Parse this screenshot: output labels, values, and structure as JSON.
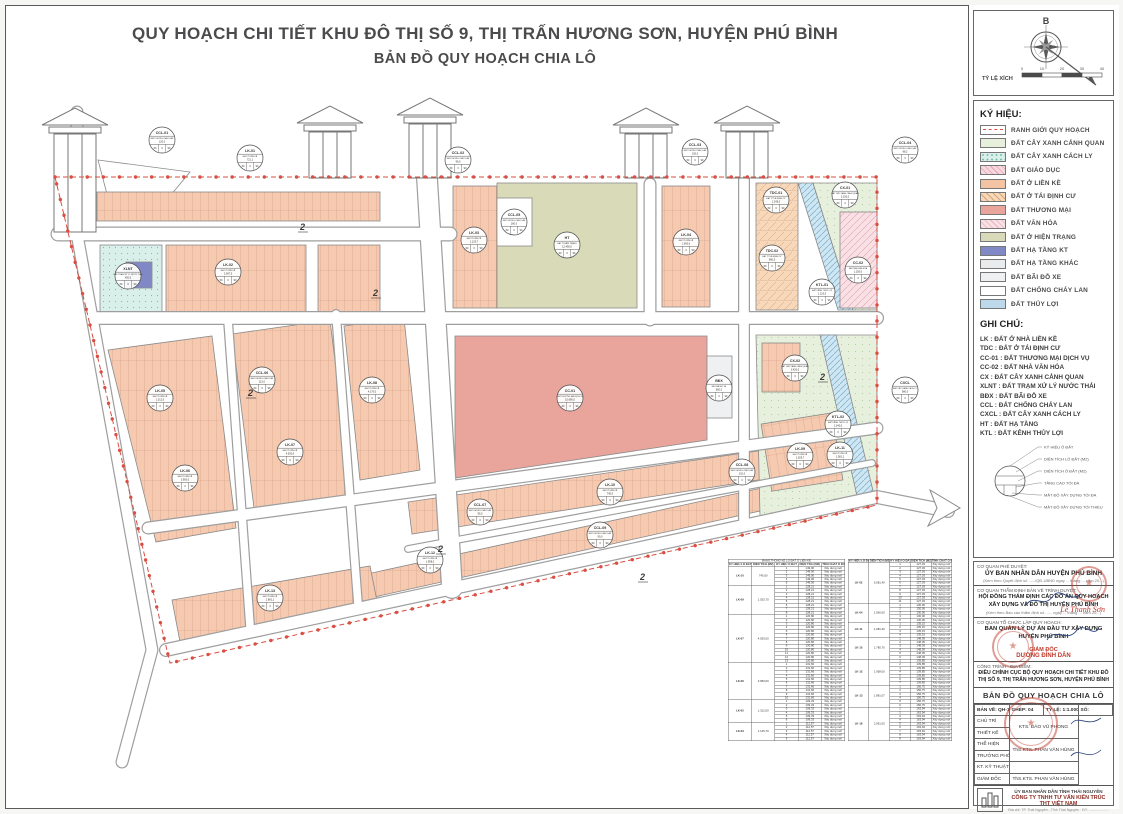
{
  "page": {
    "title_line1": "QUY HOẠCH CHI TIẾT KHU ĐÔ THỊ SỐ 9, THỊ TRẤN HƯƠNG SƠN, HUYỆN PHÚ BÌNH",
    "title_line2": "BẢN ĐỒ QUY HOẠCH CHIA LÔ"
  },
  "compass": {
    "north_label": "B",
    "scale_label": "TỶ LỆ XÍCH",
    "scale_ticks": [
      "0",
      "10",
      "20",
      "30",
      "40"
    ]
  },
  "legend": {
    "title": "KÝ HIỆU:",
    "items": [
      {
        "label": "RANH GIỚI QUY HOẠCH",
        "sw": "boundary"
      },
      {
        "label": "ĐẤT CÂY XANH CẢNH QUAN",
        "sw": "cx"
      },
      {
        "label": "ĐẤT CÂY XANH CÁCH LY",
        "sw": "cxcl"
      },
      {
        "label": "ĐẤT GIÁO DỤC",
        "sw": "gd"
      },
      {
        "label": "ĐẤT Ở LIỀN KỀ",
        "sw": "lk"
      },
      {
        "label": "ĐẤT Ở TÁI ĐỊNH CƯ",
        "sw": "tdc"
      },
      {
        "label": "ĐẤT THƯƠNG MẠI",
        "sw": "tm"
      },
      {
        "label": "ĐẤT VĂN HÓA",
        "sw": "vh"
      },
      {
        "label": "ĐẤT Ở HIỆN TRẠNG",
        "sw": "ht"
      },
      {
        "label": "ĐẤT HẠ TẦNG KT",
        "sw": "htkt"
      },
      {
        "label": "ĐẤT HẠ TẦNG KHÁC",
        "sw": "htk"
      },
      {
        "label": "ĐẤT BÃI ĐỖ XE",
        "sw": "bdx"
      },
      {
        "label": "ĐẤT CHỐNG CHÁY LAN",
        "sw": "ccl"
      },
      {
        "label": "ĐẤT THỦY LỢI",
        "sw": "tl"
      }
    ]
  },
  "notes": {
    "title": "GHI CHÚ:",
    "lines": [
      "LK : ĐẤT Ở NHÀ LIỀN KỀ",
      "TDC : ĐẤT Ở TÁI ĐỊNH CƯ",
      "CC-01 : ĐẤT THƯƠNG MẠI DỊCH VỤ",
      "CC-02 : ĐẤT NHÀ VĂN HÓA",
      "CX : ĐẤT CÂY XANH CẢNH QUAN",
      "XLNT : ĐẤT TRẠM XỬ LÝ NƯỚC THẢI",
      "BĐX : ĐẤT BÃI ĐỖ XE",
      "CCL : ĐẤT CHỐNG CHÁY LAN",
      "CXCL : ĐẤT CÂY XANH CÁCH LY",
      "HT : ĐẤT HẠ TẦNG",
      "KTL : ĐẤT KÊNH THỦY LỢI"
    ],
    "diagram_labels": [
      "KÝ HIỆU Ô ĐẤT",
      "DIỆN TÍCH LÔ ĐẤT (M2)",
      "DIỆN TÍCH Ô ĐẤT (M2)",
      "TẦNG CAO TỐI ĐA",
      "MẬT ĐỘ XÂY DỰNG TỐI ĐA",
      "MẬT ĐỘ XÂY DỰNG TỐI THIỂU"
    ]
  },
  "map": {
    "road_marker": "2",
    "cell_values": [
      "60",
      "3",
      "90"
    ],
    "zones": [
      {
        "code": "CCL-01",
        "name": "ĐẤT CHỐNG CHÁY LAN",
        "area": "120,0"
      },
      {
        "code": "LK-01",
        "name": "ĐẤT Ở LIỀN KỀ",
        "area": "721,1"
      },
      {
        "code": "CCL-02",
        "name": "ĐẤT CHỐNG CHÁY LAN",
        "area": "96,5"
      },
      {
        "code": "CCL-03",
        "name": "ĐẤT CHỐNG CHÁY LAN",
        "area": "105,0"
      },
      {
        "code": "CCL-04",
        "name": "ĐẤT CHỐNG CHÁY LAN",
        "area": "88,2"
      },
      {
        "code": "XLNT",
        "name": "ĐẤT TRẠM XỬ LÝ NƯỚC THẢI",
        "area": "420,0"
      },
      {
        "code": "LK-02",
        "name": "ĐẤT Ở LIỀN KỀ",
        "area": "2.087,5"
      },
      {
        "code": "CCL-05",
        "name": "ĐẤT CHỐNG CHÁY LAN",
        "area": "260,0"
      },
      {
        "code": "HT",
        "name": "ĐẤT Ở HIỆN TRẠNG",
        "area": "12.450,0"
      },
      {
        "code": "LK-03",
        "name": "ĐẤT Ở LIỀN KỀ",
        "area": "1.125,7"
      },
      {
        "code": "LK-04",
        "name": "ĐẤT Ở LIỀN KỀ",
        "area": "1.560,0"
      },
      {
        "code": "CC-01",
        "name": "ĐẤT THƯƠNG MẠI DỊCH VỤ",
        "area": "15.680,0"
      },
      {
        "code": "BĐX",
        "name": "ĐẤT BÃI ĐỖ XE",
        "area": "650,0"
      },
      {
        "code": "LK-05",
        "name": "ĐẤT Ở LIỀN KỀ",
        "area": "1.312,0"
      },
      {
        "code": "CCL-06",
        "name": "ĐẤT CHỐNG CHÁY LAN",
        "area": "112,0"
      },
      {
        "code": "LK-06",
        "name": "ĐẤT Ở LIỀN KỀ",
        "area": "3.950,0"
      },
      {
        "code": "LK-07",
        "name": "ĐẤT Ở LIỀN KỀ",
        "area": "4.530,0"
      },
      {
        "code": "LK-08",
        "name": "ĐẤT Ở LIỀN KỀ",
        "area": "4.170,0"
      },
      {
        "code": "TDC-01",
        "name": "ĐẤT Ở TÁI ĐỊNH CƯ",
        "area": "1.245,0"
      },
      {
        "code": "TDC-02",
        "name": "ĐẤT Ở TÁI ĐỊNH CƯ",
        "area": "980,5"
      },
      {
        "code": "KTL-01",
        "name": "ĐẤT KÊNH THỦY LỢI",
        "area": "1.120,0"
      },
      {
        "code": "CX-01",
        "name": "ĐẤT CÂY XANH CẢNH QUAN",
        "area": "2.150,0"
      },
      {
        "code": "CC-02",
        "name": "ĐẤT NHÀ VĂN HÓA",
        "area": "1.250,0"
      },
      {
        "code": "CX-02",
        "name": "ĐẤT CÂY XANH CẢNH QUAN",
        "area": "3.420,0"
      },
      {
        "code": "KTL-02",
        "name": "ĐẤT KÊNH THỦY LỢI",
        "area": "1.340,0"
      },
      {
        "code": "LK-09",
        "name": "ĐẤT Ở LIỀN KỀ",
        "area": "1.025,7"
      },
      {
        "code": "CXCL",
        "name": "ĐẤT CÂY XANH CÁCH LY",
        "area": "980,0"
      },
      {
        "code": "CCL-07",
        "name": "ĐẤT CHỐNG CHÁY LAN",
        "area": "95,0"
      },
      {
        "code": "LK-10",
        "name": "ĐẤT Ở LIỀN KỀ",
        "area": "745,0"
      },
      {
        "code": "CCL-08",
        "name": "ĐẤT CHỐNG CHÁY LAN",
        "area": "102,0"
      },
      {
        "code": "LK-11",
        "name": "ĐẤT Ở LIỀN KỀ",
        "area": "1.081,2"
      },
      {
        "code": "LK-12",
        "name": "ĐẤT Ở LIỀN KỀ",
        "area": "1.958,0"
      },
      {
        "code": "CCL-09",
        "name": "ĐẤT CHỐNG CHÁY LAN",
        "area": "90,0"
      },
      {
        "code": "LK-13",
        "name": "ĐẤT Ở LIỀN KỀ",
        "area": "1.881,1"
      }
    ]
  },
  "tables": [
    {
      "title": "BẢNG THỐNG KÊ LÔ ĐẤT Ở LIỀN KỀ",
      "columns": [
        "KÝ HIỆU LÔ ĐẤT",
        "DIỆN TÍCH (M2)",
        "KÝ HIỆU Ô ĐẤT",
        "DIỆN TÍCH (M2)",
        "TÍNH CHẤT Ô ĐẤT"
      ],
      "groups": [
        {
          "code": "LK-10",
          "area": "745,00",
          "n": 5,
          "lot_area": "149,00",
          "note": "Xây dựng mới"
        },
        {
          "code": "LK-09",
          "area": "1.025,70",
          "n": 8,
          "lot_area": "128,21",
          "note": "Xây dựng mới"
        },
        {
          "code": "LK-07",
          "area": "4.530,00",
          "n": 13,
          "lot_area": "120,80",
          "note": "Xây dựng mới"
        },
        {
          "code": "LK-06",
          "area": "3.950,00",
          "n": 10,
          "lot_area": "131,66",
          "note": "Xây dựng mới"
        },
        {
          "code": "LK-05",
          "area": "1.312,00",
          "n": 6,
          "lot_area": "109,33",
          "note": "Xây dựng mới"
        },
        {
          "code": "LK-03",
          "area": "1.125,70",
          "n": 5,
          "lot_area": "112,57",
          "note": "Xây dựng mới"
        }
      ]
    },
    {
      "title": "",
      "columns": [
        "KÝ HIỆU LÔ ĐẤT",
        "DIỆN TÍCH (M2)",
        "KÝ HIỆU Ô ĐẤT",
        "DIỆN TÍCH (M2)",
        "TÍNH CHẤT Ô ĐẤT"
      ],
      "groups": [
        {
          "code": "LK-02",
          "area": "5.081,40",
          "n": 11,
          "lot_area": "127,03",
          "note": "Xây dựng mới"
        },
        {
          "code": "LK-04",
          "area": "1.560,00",
          "n": 5,
          "lot_area": "130,00",
          "note": "Xây dựng mới"
        },
        {
          "code": "LK-11",
          "area": "1.081,20",
          "n": 4,
          "lot_area": "135,15",
          "note": "Xây dựng mới"
        },
        {
          "code": "LK-15",
          "area": "1.780,70",
          "n": 6,
          "lot_area": "148,39",
          "note": "Xây dựng mới"
        },
        {
          "code": "LK-12",
          "area": "1.958,00",
          "n": 7,
          "lot_area": "139,85",
          "note": "Xây dựng mới"
        },
        {
          "code": "LK-13",
          "area": "1.881,07",
          "n": 6,
          "lot_area": "156,75",
          "note": "Xây dựng mới"
        },
        {
          "code": "LK-18",
          "area": "2.951,00",
          "n": 9,
          "lot_area": "163,94",
          "note": "Xây dựng mới"
        }
      ]
    }
  ],
  "title_block": {
    "row1_label": "CƠ QUAN PHÊ DUYỆT:",
    "row1_value": "ỦY BAN NHÂN DÂN HUYỆN PHÚ BÌNH",
    "row1_sub": "(Kèm theo Quyết định số ....../QĐ-UBND ngày ... tháng ... năm 20...)",
    "row2_label": "CƠ QUAN THẨM ĐỊNH BẢN VẼ TRÌNH DUYỆT:",
    "row2_value": "HỘI ĐỒNG THẨM ĐỊNH CÁC ĐỒ ÁN QUY HOẠCH XÂY DỰNG VÀ ĐÔ THỊ HUYỆN PHÚ BÌNH",
    "row2_sub": "(Kèm theo Báo cáo thẩm định số ...... ngày ... tháng ... năm 20...)",
    "row2_signer": "Lê Thanh Sơn",
    "row3_label": "CƠ QUAN TỔ CHỨC LẬP QUY HOẠCH:",
    "row3_value": "BAN QUẢN LÝ DỰ ÁN ĐẦU TƯ XÂY DỰNG HUYỆN PHÚ BÌNH",
    "row3_role": "GIÁM ĐỐC",
    "row3_signer": "DƯƠNG ĐÌNH DÂN",
    "row4_label": "CÔNG TRÌNH - ĐỊA ĐIỂM:",
    "row4_value": "ĐIỀU CHỈNH CỤC BỘ QUY HOẠCH CHI TIẾT KHU ĐÔ THỊ SỐ 9, THỊ TRẤN HƯƠNG SƠN, HUYỆN PHÚ BÌNH",
    "drawing_label": "TÊN BẢN VẼ:",
    "drawing_title": "BẢN ĐỒ QUY HOẠCH CHIA LÔ",
    "grid": {
      "sheet_label": "BẢN VẼ:",
      "sheet_value": "QH-14",
      "set_label": "GHÉP:",
      "set_value": "04",
      "scale_label": "TỶ LỆ:",
      "scale_value": "1:1.000",
      "num_label": "SỐ:",
      "num_value": ""
    },
    "personnel": [
      [
        "CHỦ TRÌ",
        "KTS. ĐÀO VŨ PHONG"
      ],
      [
        "THIẾT KẾ",
        "KTS. ĐÀO VŨ PHONG"
      ],
      [
        "THỂ HIỆN",
        "ThS.KTS. PHAN VĂN HÙNG"
      ],
      [
        "TRƯỞNG PHÒNG",
        "ThS.KTS. PHAN VĂN HÙNG"
      ],
      [
        "KT. KỸ THUẬT",
        ""
      ],
      [
        "GIÁM ĐỐC",
        "ThS.KTS. PHAN VĂN HÙNG"
      ]
    ],
    "company_line1": "ỦY BAN NHÂN DÂN TỈNH THÁI NGUYÊN",
    "company_line2": "CÔNG TY TNHH TƯ VẤN KIẾN TRÚC THT VIỆT NAM",
    "company_line3": "Địa chỉ: TP. Thái Nguyên - Tỉnh Thái Nguyên · ĐT: ....................",
    "logo_text": "THT"
  },
  "colors": {
    "boundary": "#d94f43",
    "residential_lk": "#f3c3a3",
    "resettlement_tdc": "#f8d8ba",
    "commercial": "#e9a49c",
    "culture": "#f9e0e5",
    "existing_housing": "#d9dab8",
    "infrastructure_kt": "#8089c6",
    "parking": "#eef0f1",
    "irrigation": "#bcd9ec",
    "greenery": "#e6f0dc",
    "isolation_green": "#d9efe9",
    "education": "#f6d9de",
    "stamp_red": "#c0392b"
  }
}
